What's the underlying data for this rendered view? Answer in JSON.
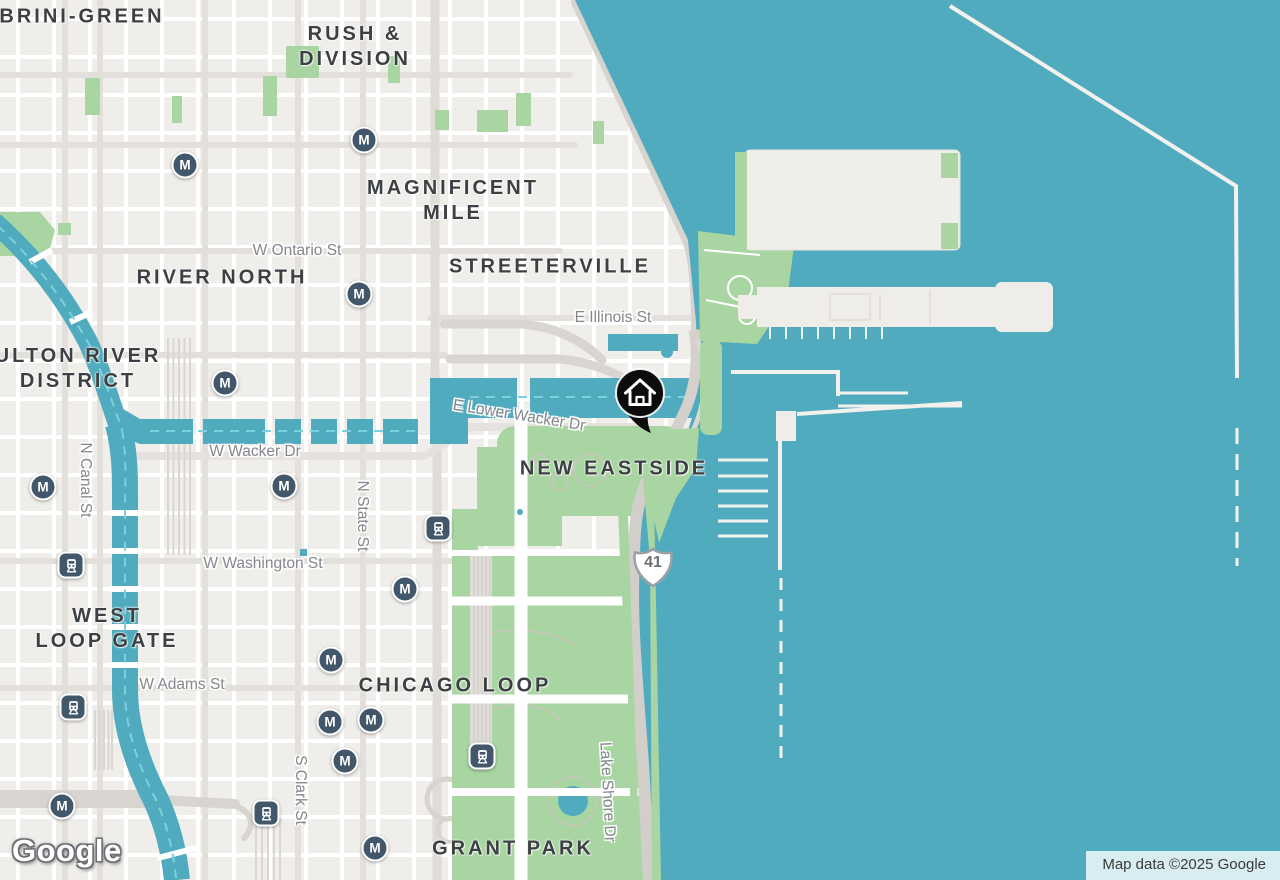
{
  "map": {
    "attribution": "Map data ©2025 Google",
    "logo_text": "Google",
    "route_shield": "41",
    "glyphs": {
      "metro": "M"
    },
    "colors": {
      "water": "#50ABBE",
      "land": "#F0EEEA",
      "park": "#A8D5A2",
      "marker_bg": "#42586A",
      "area_label": "#3C4043",
      "street_label": "#84888D"
    },
    "home_marker": {
      "x": 640,
      "y": 394,
      "icon": "home-icon"
    },
    "shield_pos": {
      "x": 653,
      "y": 567
    },
    "area_labels": [
      {
        "lines": [
          "BRINI-GREEN"
        ],
        "x": 82,
        "y": 17
      },
      {
        "lines": [
          "RUSH &",
          "DIVISION"
        ],
        "x": 355,
        "y": 47
      },
      {
        "lines": [
          "MAGNIFICENT",
          "MILE"
        ],
        "x": 453,
        "y": 201
      },
      {
        "lines": [
          "RIVER NORTH"
        ],
        "x": 222,
        "y": 278
      },
      {
        "lines": [
          "STREETERVILLE"
        ],
        "x": 550,
        "y": 267
      },
      {
        "lines": [
          "ULTON RIVER",
          "DISTRICT"
        ],
        "x": 78,
        "y": 369
      },
      {
        "lines": [
          "NEW EASTSIDE"
        ],
        "x": 614,
        "y": 469
      },
      {
        "lines": [
          "WEST",
          "LOOP GATE"
        ],
        "x": 107,
        "y": 629
      },
      {
        "lines": [
          "CHICAGO LOOP"
        ],
        "x": 455,
        "y": 686
      },
      {
        "lines": [
          "GRANT PARK"
        ],
        "x": 513,
        "y": 849
      }
    ],
    "street_labels": [
      {
        "text": "W Ontario St",
        "x": 297,
        "y": 251,
        "rot": 0
      },
      {
        "text": "E Illinois St",
        "x": 613,
        "y": 318,
        "rot": 0
      },
      {
        "text": "E Lower Wacker Dr",
        "x": 519,
        "y": 416,
        "rot": 9
      },
      {
        "text": "W Wacker Dr",
        "x": 255,
        "y": 452,
        "rot": 0
      },
      {
        "text": "N Canal St",
        "x": 85,
        "y": 480,
        "rot": 90
      },
      {
        "text": "N State St",
        "x": 362,
        "y": 516,
        "rot": 90
      },
      {
        "text": "W Washington St",
        "x": 263,
        "y": 564,
        "rot": 0
      },
      {
        "text": "W Adams St",
        "x": 182,
        "y": 685,
        "rot": 0
      },
      {
        "text": "S Clark St",
        "x": 300,
        "y": 790,
        "rot": 90
      },
      {
        "text": "Lake Shore Dr",
        "x": 607,
        "y": 792,
        "rot": 87
      }
    ],
    "transit_markers": [
      {
        "type": "metro",
        "x": 185,
        "y": 165
      },
      {
        "type": "metro",
        "x": 364,
        "y": 140
      },
      {
        "type": "metro",
        "x": 359,
        "y": 294
      },
      {
        "type": "metro",
        "x": 225,
        "y": 383
      },
      {
        "type": "metro",
        "x": 43,
        "y": 487
      },
      {
        "type": "metro",
        "x": 284,
        "y": 486
      },
      {
        "type": "metro",
        "x": 405,
        "y": 589
      },
      {
        "type": "metro",
        "x": 331,
        "y": 660
      },
      {
        "type": "metro",
        "x": 330,
        "y": 722
      },
      {
        "type": "metro",
        "x": 371,
        "y": 720
      },
      {
        "type": "metro",
        "x": 345,
        "y": 761
      },
      {
        "type": "metro",
        "x": 62,
        "y": 806
      },
      {
        "type": "metro",
        "x": 375,
        "y": 848
      },
      {
        "type": "train",
        "x": 71,
        "y": 565
      },
      {
        "type": "train",
        "x": 438,
        "y": 528
      },
      {
        "type": "train",
        "x": 73,
        "y": 707
      },
      {
        "type": "train",
        "x": 482,
        "y": 756
      },
      {
        "type": "train",
        "x": 266,
        "y": 813
      }
    ]
  }
}
